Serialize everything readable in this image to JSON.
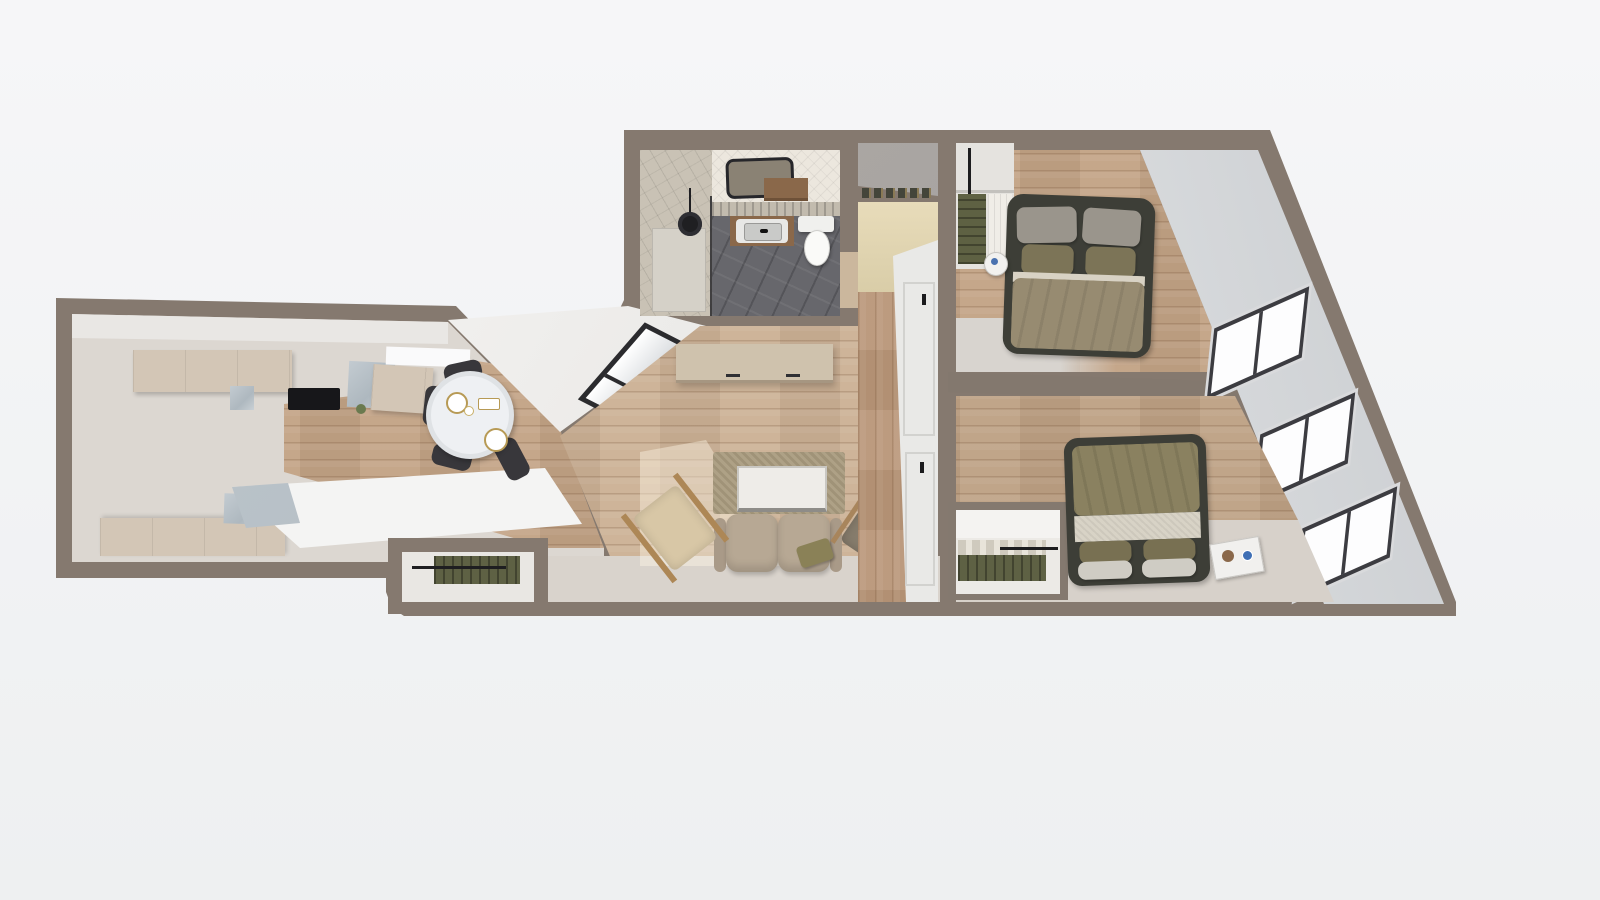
{
  "figure_type": "3d-rendered top-down apartment floor plan, no visible text",
  "palette": {
    "page_background": "#f5f5f7",
    "wall": "#85796f",
    "interior_plaster_floor": "#dcd7d1",
    "wood_floor": "#c2a284",
    "sloped_wall_face": "#e9ebec",
    "kitchen_cabinet": "#d3c6b6",
    "marble_counter": "#b8c2c9",
    "bathroom_tile_floor": "#67676c",
    "herringbone_wall_tile": "#ece7de",
    "bed_frame": "#3d3e37",
    "bedding_taupe": "#978b71",
    "bedding_olive": "#8a8160",
    "sofa": "#b7a894",
    "rug": "#a99b7e",
    "hanging_clothes_olive": "#5e6144",
    "accent_wall_yellow": "#e3d7b4",
    "window_frame": "#3c3c41",
    "window_glass": "#fdfdfe",
    "dining_chair": "#38373b",
    "coffee_table_marble": "#eeece8"
  },
  "rooms": [
    {
      "name": "kitchen",
      "position": "far left",
      "features": [
        "upper cabinet run with black cooktop",
        "marble backsplash blocks",
        "lower cabinet run",
        "white peninsula counter",
        "wood floor strip"
      ]
    },
    {
      "name": "dining-area",
      "position": "center left",
      "features": [
        "round table with white cloth and gold-rim plates",
        "four dark chairs"
      ]
    },
    {
      "name": "living-room",
      "position": "center",
      "features": [
        "beige sideboard",
        "taupe rug",
        "white marble coffee table",
        "two-seat sofa with olive pillow",
        "two accent chairs",
        "skylight on sloped wall",
        "sunlight patch"
      ]
    },
    {
      "name": "bathroom",
      "position": "top center",
      "features": [
        "tiled shower with glass panel",
        "black ceiling lamp",
        "mirror",
        "wood vanity with white sink",
        "toilet",
        "dark patterned tile floor",
        "herringbone tiled wall"
      ]
    },
    {
      "name": "entry-hall",
      "position": "center, between bathroom and bedrooms",
      "features": [
        "shoe shelf",
        "pale yellow wall",
        "wood corridor",
        "two white paneled doors with black handles"
      ]
    },
    {
      "name": "bedroom-1",
      "position": "top right",
      "features": [
        "double bed with dark frame, gray and olive pillows",
        "round white nightstand",
        "open closet with olive clothes and curtain",
        "window on slanted wall"
      ]
    },
    {
      "name": "bedroom-2",
      "position": "bottom right",
      "features": [
        "double bed with olive duvet, pillows at foot",
        "white nightstand with blue cup",
        "open wardrobe cutaway with folded and hanging clothes",
        "two windows on slanted wall",
        "carpet strip"
      ]
    },
    {
      "name": "hall-closet",
      "position": "bottom center",
      "features": [
        "open closet cutaway with olive hanging clothes on rail"
      ]
    }
  ],
  "windows": {
    "right_slanted_wall": 3,
    "skylight_left": 1,
    "kitchen_light_strip": 1
  },
  "doors": {
    "white_paneled_interior_doors": 2,
    "bathroom_door_gap": 1
  },
  "geometry": {
    "outline": "irregular polygon with V-notch between kitchen and living zone and long diagonal exterior wall on the right",
    "canvas": [
      1600,
      900
    ]
  }
}
